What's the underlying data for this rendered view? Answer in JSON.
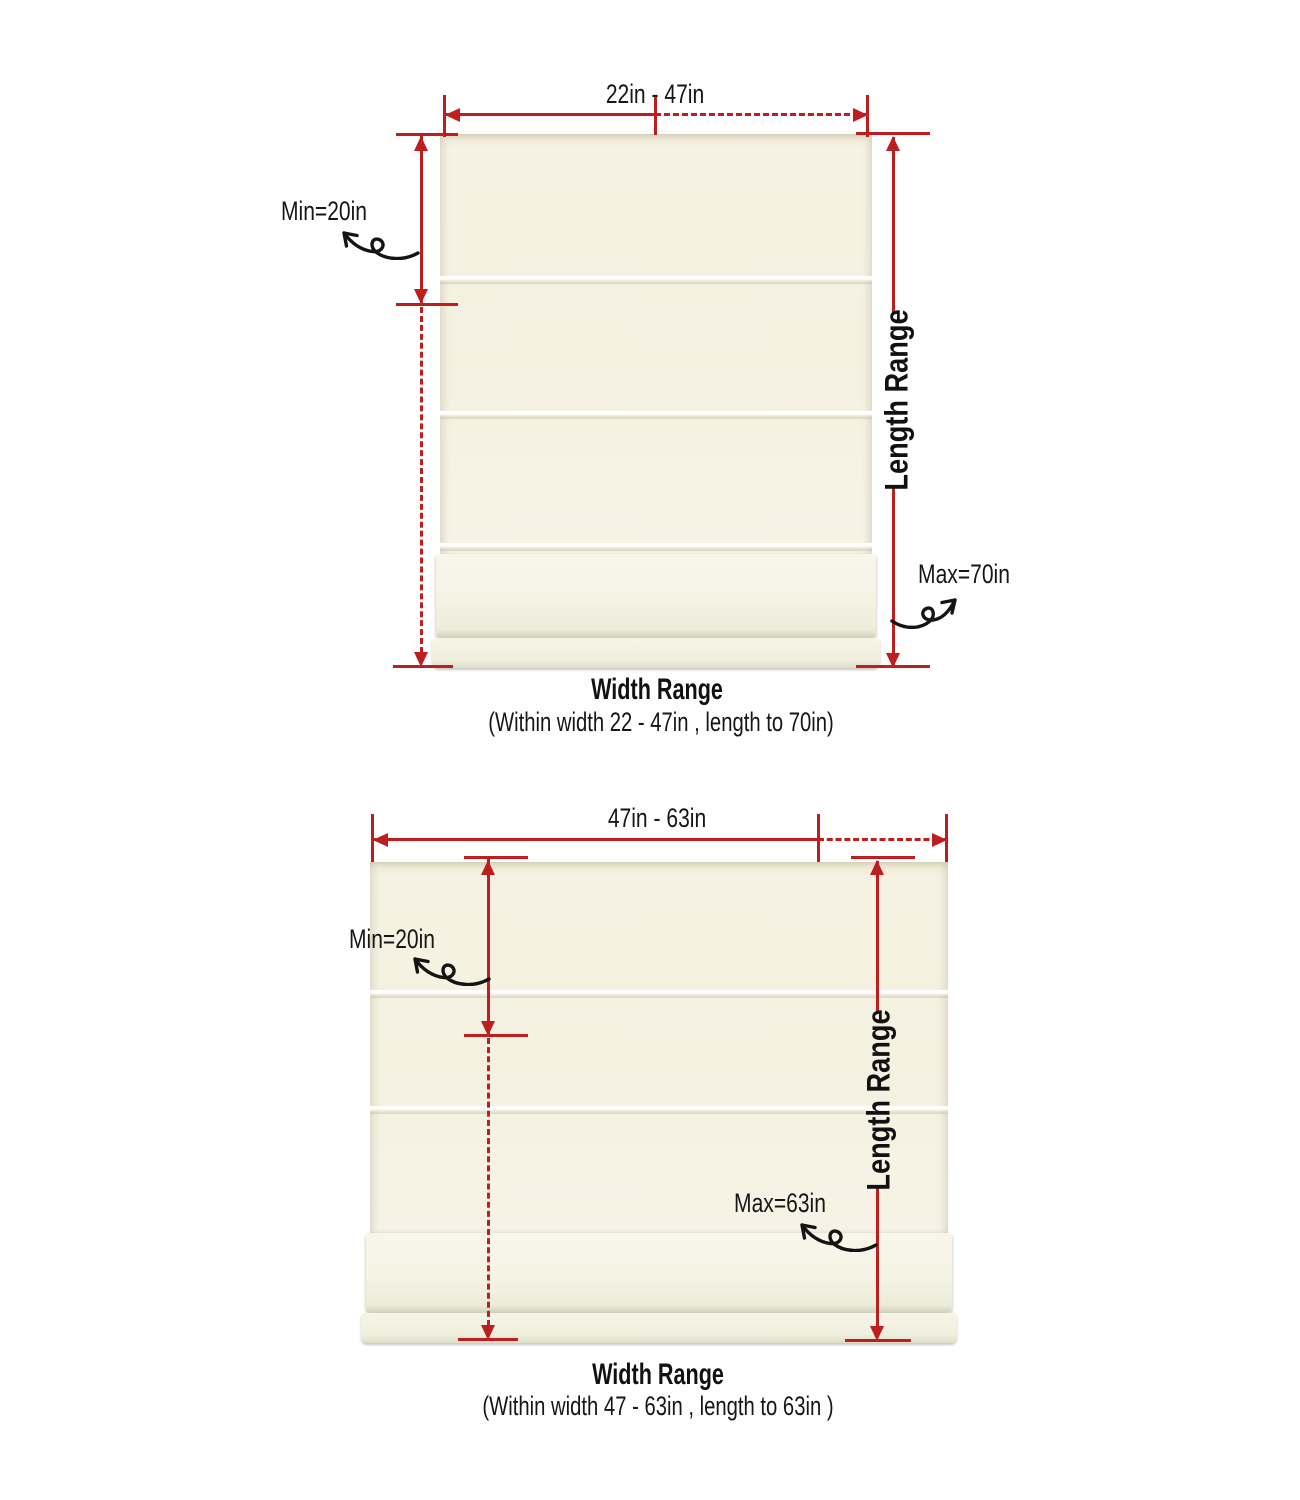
{
  "colors": {
    "background": "#ffffff",
    "dimension_red": "#bf1e1e",
    "text": "#161616",
    "shade_cream": "#f5f1e2"
  },
  "icons": {
    "curl_arrow": "hand-drawn curly loop arrow pointing from annotation line to label",
    "dimension_arrow": "triangular red arrowhead on dimension lines"
  },
  "diagrams": [
    {
      "name": "narrow width variant",
      "width_label": "22in - 47in",
      "min_label": "Min=20in",
      "max_label": "Max=70in",
      "length_axis_label": "Length Range",
      "caption_title": "Width Range",
      "caption_subtitle": "(Within width 22 - 47in , length to 70in)"
    },
    {
      "name": "wide width variant",
      "width_label": "47in - 63in",
      "min_label": "Min=20in",
      "max_label": "Max=63in",
      "length_axis_label": "Length Range",
      "caption_title": "Width Range",
      "caption_subtitle": "(Within width 47 - 63in , length to 63in )"
    }
  ]
}
